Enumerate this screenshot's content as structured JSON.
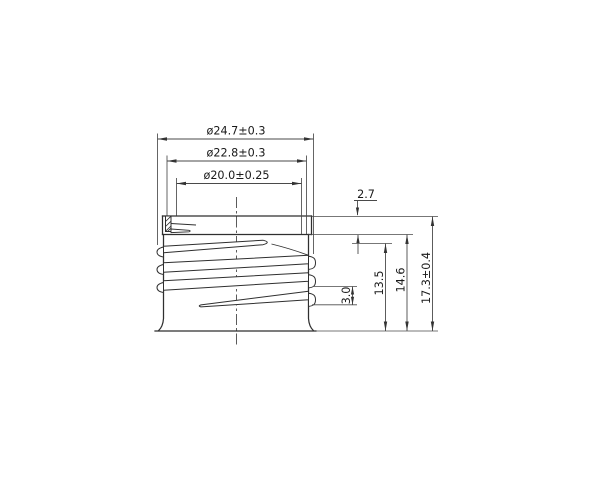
{
  "drawing": {
    "colors": {
      "background": "#ffffff",
      "main_line": "#2f2f2f",
      "thin_line": "#4a4a4a",
      "text": "#1a1a1a"
    },
    "labels": {
      "dia_outer": "ø24.7±0.3",
      "dia_mid": "ø22.8±0.3",
      "dia_bore": "ø20.0±0.25",
      "lip_height": "2.7",
      "thread_pitch": "3.0",
      "height_thread": "13.5",
      "height_below_lip": "14.6",
      "height_total": "17.3±0.4"
    }
  }
}
